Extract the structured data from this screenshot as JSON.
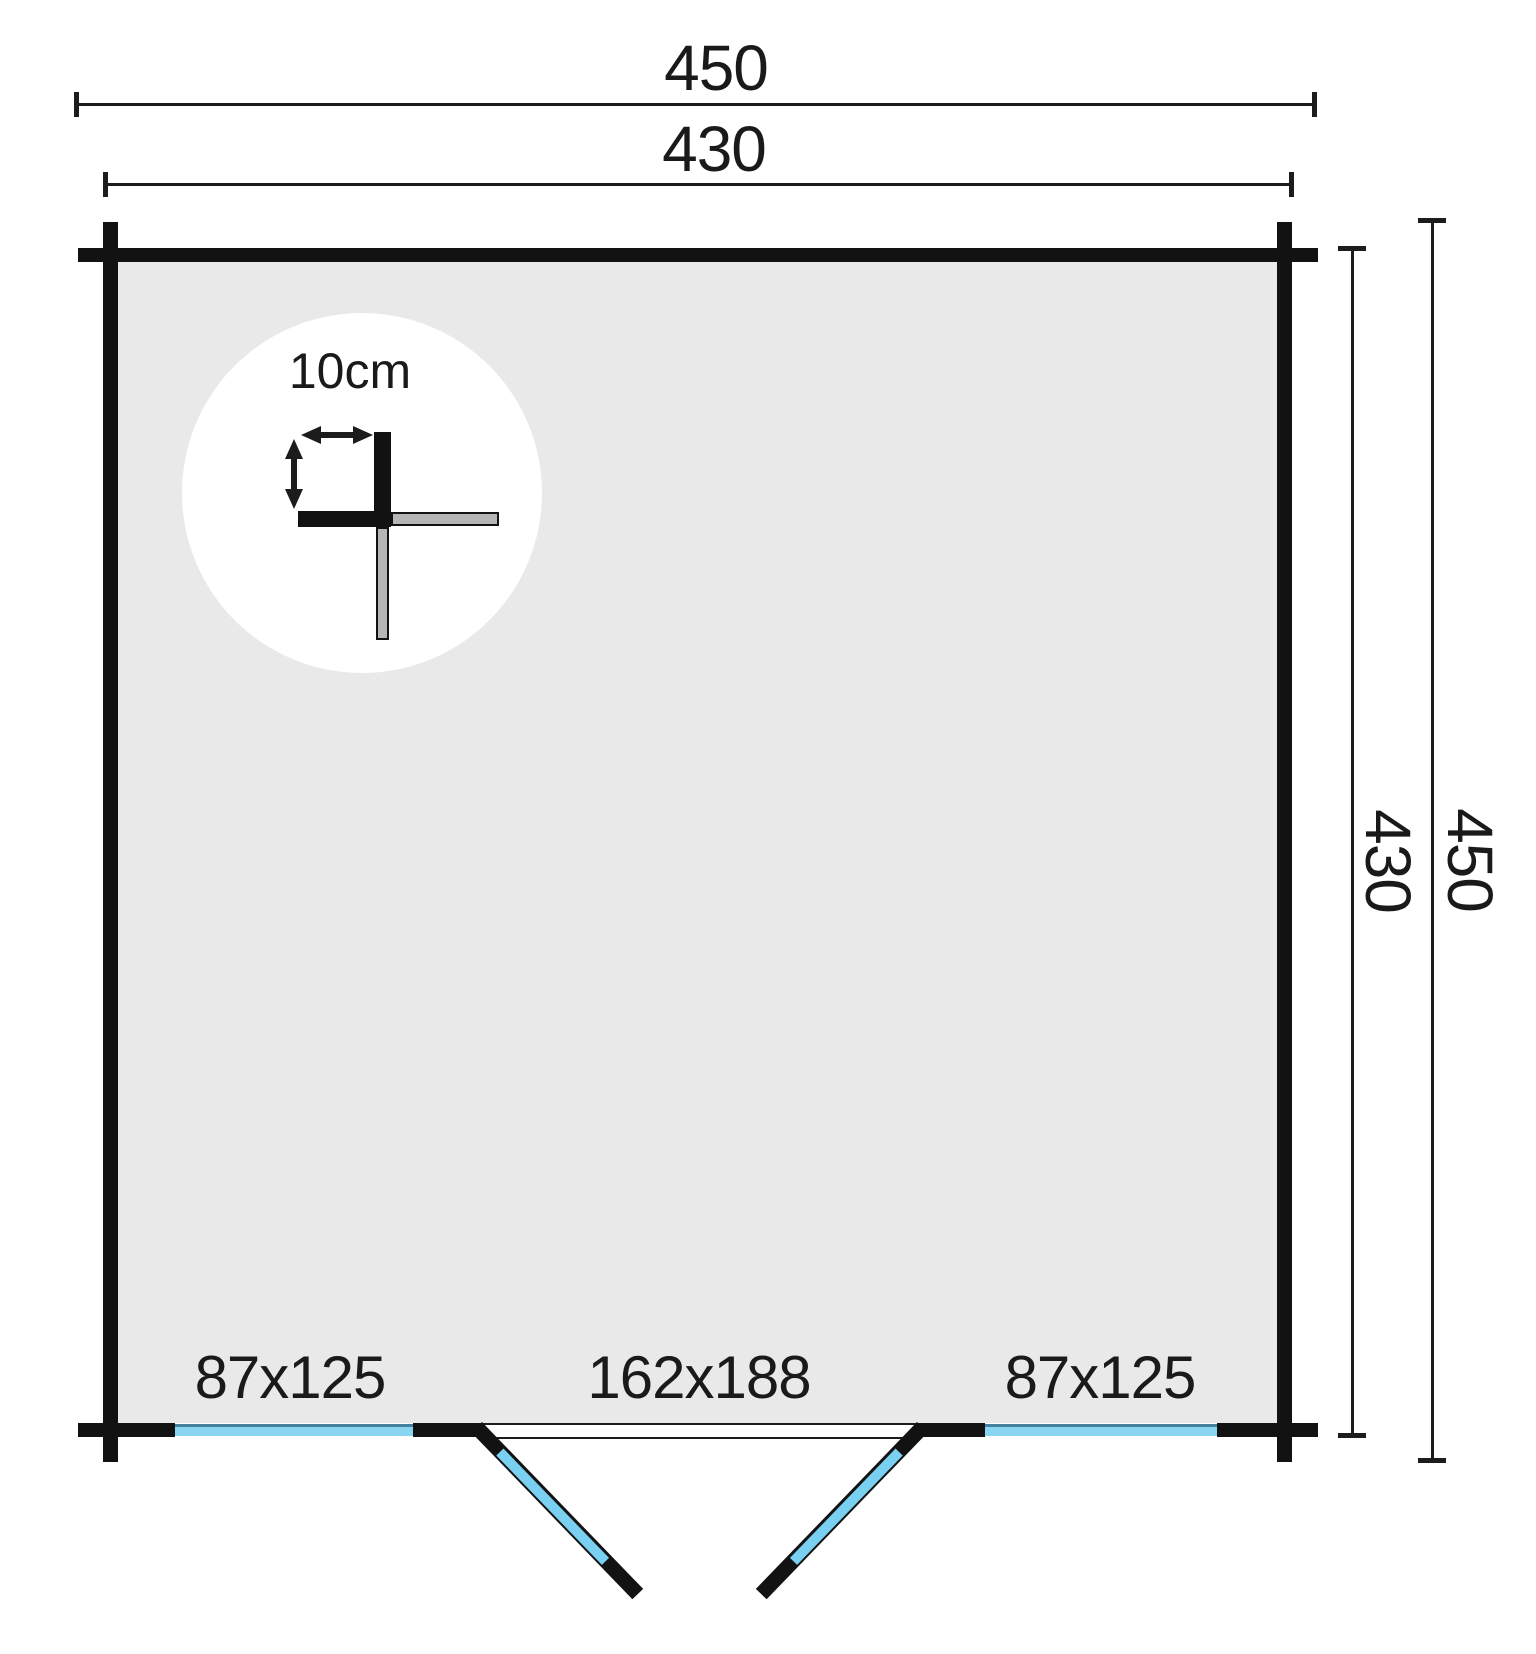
{
  "dimensions": {
    "top_outer": "450",
    "top_inner": "430",
    "right_inner": "430",
    "right_outer": "450"
  },
  "wall_detail": {
    "thickness_label": "10cm"
  },
  "openings": {
    "left_window_label": "87x125",
    "door_label": "162x188",
    "right_window_label": "87x125"
  },
  "colors": {
    "wall": "#121212",
    "line": "#1c1c1c",
    "text": "#1a1a1a",
    "interior": "#e9e9e9",
    "window_blue": "#8ad5f2",
    "window_edge": "#44819f",
    "door_blue": "#79d0f0",
    "joint_gray": "#b5b5b5",
    "background": "#ffffff"
  }
}
